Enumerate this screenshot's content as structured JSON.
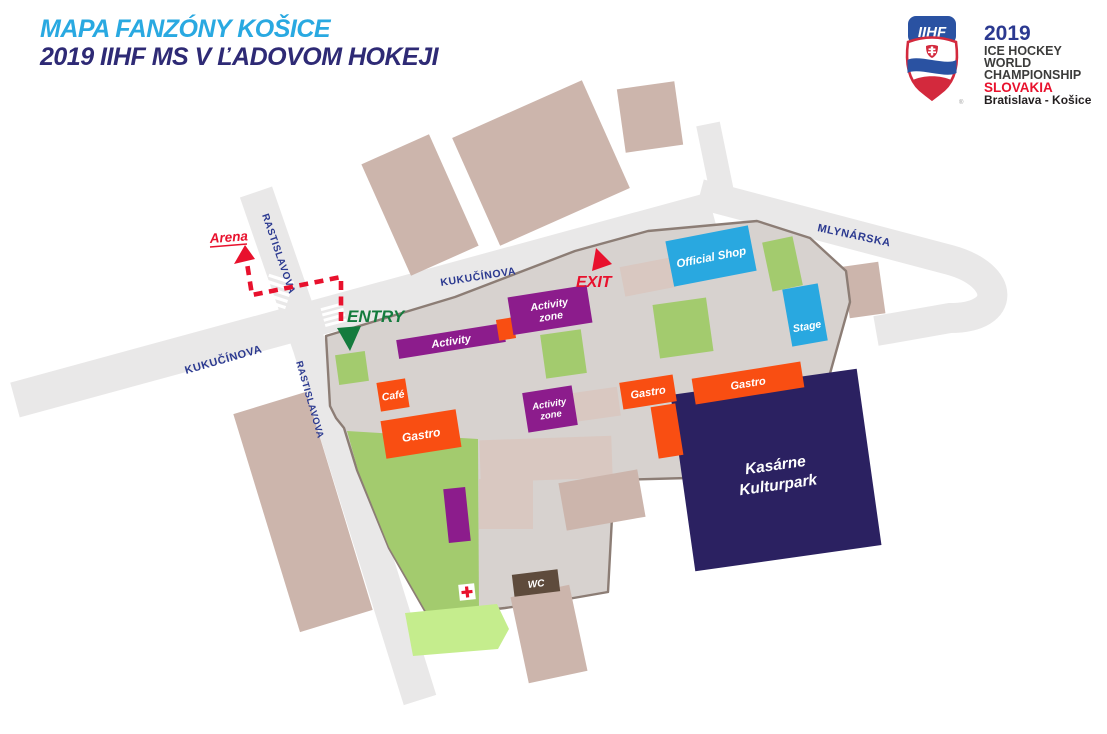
{
  "header": {
    "title_line1": "MAPA FANZÓNY KOŠICE",
    "title_line2": "2019 IIHF MS V ĽADOVOM HOKEJI"
  },
  "logo": {
    "iihf": "IIHF",
    "year": "2019",
    "event_line1": "ICE HOCKEY",
    "event_line2": "WORLD",
    "event_line3": "CHAMPIONSHIP",
    "country": "SLOVAKIA",
    "cities": "Bratislava - Košice",
    "registered": "®"
  },
  "streets": {
    "kukucinova": "KUKUČÍNOVA",
    "rastislavova": "RASTISLAVOVA",
    "mlynarska": "MLYNÁRSKA"
  },
  "route": {
    "arena_label": "Arena",
    "entry_label": "ENTRY",
    "exit_label": "EXIT"
  },
  "venues": {
    "official_shop": "Official Shop",
    "stage": "Stage",
    "activity": "Activity",
    "activity_zone_line1": "Activity",
    "activity_zone_line2": "zone",
    "cafe": "Café",
    "gastro": "Gastro",
    "wc": "WC",
    "kasarne_line1": "Kasárne",
    "kasarne_line2": "Kulturpark"
  },
  "colors": {
    "title_blue": "#29a9e1",
    "title_dark": "#2e2a75",
    "street_gray": "#e9e8e8",
    "street_label_navy": "#2b3990",
    "building_beige": "#ccb5ac",
    "fanzone_gray": "#d7d2cf",
    "fanzone_border": "#8c7d75",
    "green_zone": "#a3cb6e",
    "light_green": "#c5ed8d",
    "activity_purple": "#8c1c8c",
    "gastro_orange": "#f94e12",
    "shop_stage_blue": "#29a8e0",
    "kasarne_navy": "#2b2161",
    "wc_brown": "#5e4b3c",
    "route_red": "#e8112d",
    "entry_green": "#147b3d",
    "slovakia_red": "#e8112d"
  }
}
